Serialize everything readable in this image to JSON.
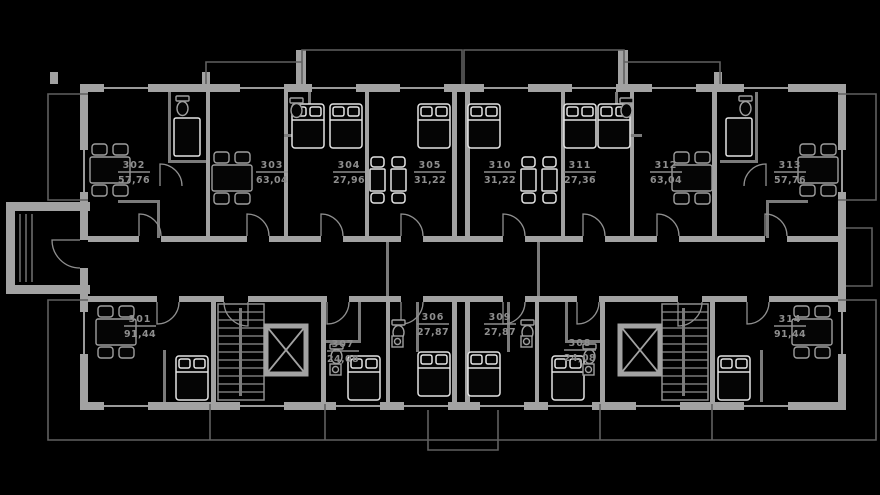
{
  "plan": {
    "floor_label": "floor-plan",
    "units": [
      {
        "number": "302",
        "area": "57,76"
      },
      {
        "number": "303",
        "area": "63,04"
      },
      {
        "number": "304",
        "area": "27,96"
      },
      {
        "number": "305",
        "area": "31,22"
      },
      {
        "number": "310",
        "area": "31,22"
      },
      {
        "number": "311",
        "area": "27,36"
      },
      {
        "number": "312",
        "area": "63,04"
      },
      {
        "number": "313",
        "area": "57,76"
      },
      {
        "number": "301",
        "area": "91,44"
      },
      {
        "number": "307",
        "area": "24,08"
      },
      {
        "number": "306",
        "area": "27,87"
      },
      {
        "number": "309",
        "area": "27,87"
      },
      {
        "number": "308",
        "area": "24,08"
      },
      {
        "number": "314",
        "area": "91,44"
      }
    ],
    "colors": {
      "background": "#000000",
      "walls": "#a2a2a2",
      "partitions": "#7b7b7b",
      "furniture_bright": "#e4e4e4",
      "fixtures": "#9f9f9f",
      "rails": "#606060",
      "label_text": "#8e8e8e"
    }
  }
}
